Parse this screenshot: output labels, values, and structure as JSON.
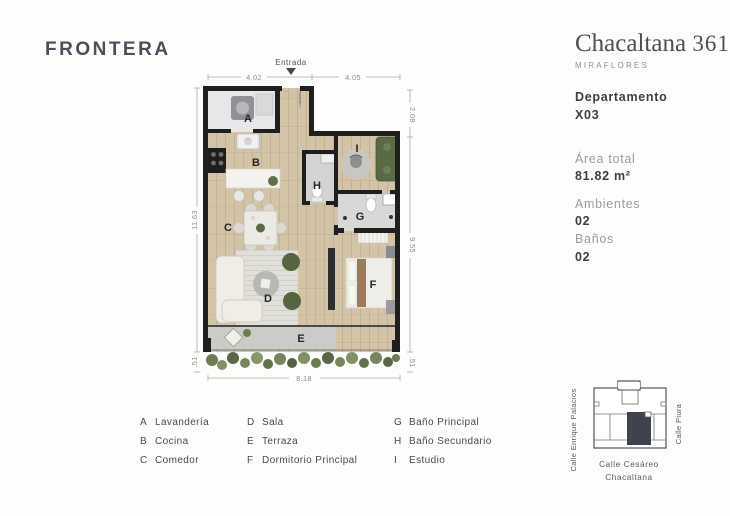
{
  "brand": {
    "logo": "FRONTERA"
  },
  "project": {
    "name": "Chacaltana",
    "number": "361",
    "district": "MIRAFLORES"
  },
  "unit": {
    "type_label": "Departamento",
    "code": "X03",
    "area_label": "Área total",
    "area_value": "81.82 m²",
    "rooms_label": "Ambientes",
    "rooms_value": "02",
    "baths_label": "Baños",
    "baths_value": "02"
  },
  "plan": {
    "entrance_label": "Entrada",
    "dims": {
      "top_left": "4.02",
      "top_right": "4.05",
      "right_top": "2.08",
      "right_mid": "9.55",
      "right_bottom": ".51",
      "left": "11.63",
      "left_bottom": ".51",
      "bottom": "8.18"
    },
    "letters": {
      "A": "A",
      "B": "B",
      "C": "C",
      "D": "D",
      "E": "E",
      "F": "F",
      "G": "G",
      "H": "H",
      "I": "I"
    }
  },
  "legend": {
    "columns": [
      [
        {
          "letter": "A",
          "label": "Lavandería"
        },
        {
          "letter": "B",
          "label": "Cocina"
        },
        {
          "letter": "C",
          "label": "Comedor"
        }
      ],
      [
        {
          "letter": "D",
          "label": "Sala"
        },
        {
          "letter": "E",
          "label": "Terraza"
        },
        {
          "letter": "F",
          "label": "Dormitorio Principal"
        }
      ],
      [
        {
          "letter": "G",
          "label": "Baño Principal"
        },
        {
          "letter": "H",
          "label": "Baño Secundario"
        },
        {
          "letter": "I",
          "label": "Estudio"
        }
      ]
    ]
  },
  "map": {
    "street_left": "Calle Enrique Palacios",
    "street_right": "Calle Piura",
    "street_bottom_line1": "Calle Cesáreo",
    "street_bottom_line2": "Chacaltana"
  },
  "colors": {
    "wall": "#1f1f1f",
    "wood_floor": "#d3c4a8",
    "tile_floor": "#d7d7d5",
    "accent_green": "#5c6b47",
    "text_dark": "#3e3e40",
    "text_gray": "#9b9b9b",
    "map_unit_fill": "#3f434b"
  }
}
